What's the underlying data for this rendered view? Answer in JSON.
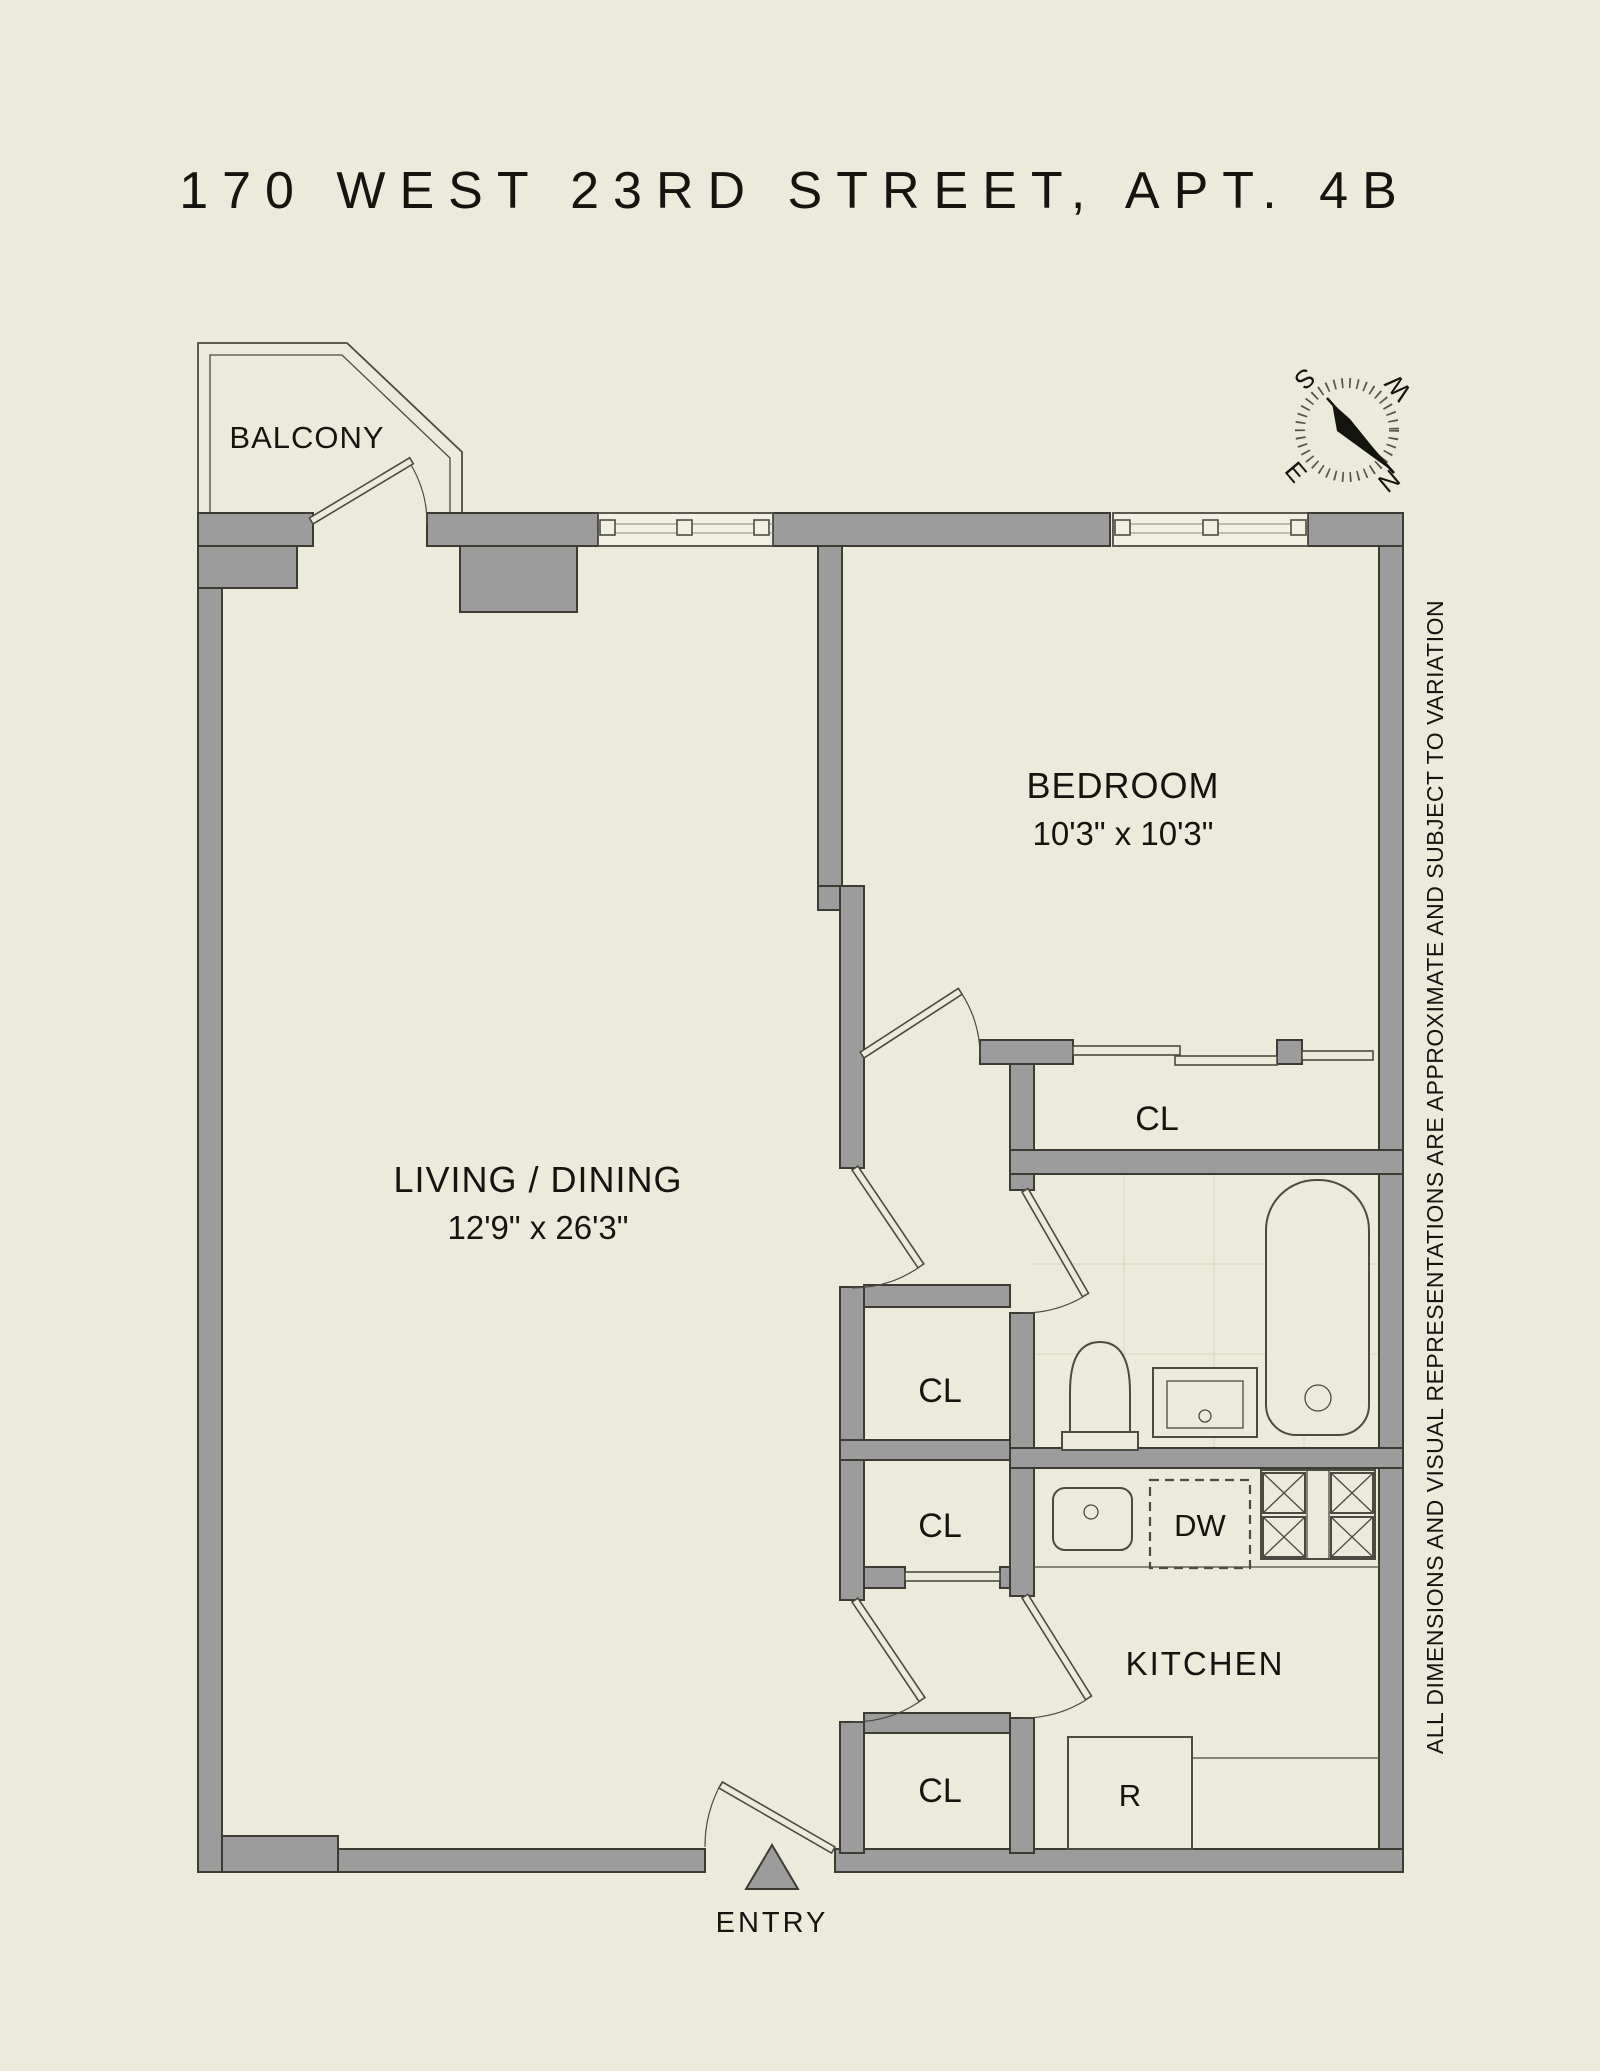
{
  "title": "170 WEST 23RD STREET, APT. 4B",
  "disclaimer": "ALL DIMENSIONS AND VISUAL REPRESENTATIONS ARE APPROXIMATE AND SUBJECT TO VARIATION",
  "rooms": {
    "balcony": {
      "label": "BALCONY"
    },
    "bedroom": {
      "label": "BEDROOM",
      "dims": "10'3\" x 10'3\""
    },
    "living": {
      "label": "LIVING / DINING",
      "dims": "12'9\" x 26'3\""
    },
    "kitchen": {
      "label": "KITCHEN"
    },
    "entry": {
      "label": "ENTRY"
    }
  },
  "closets": {
    "bedroom_closet": "CL",
    "hall_closet_upper": "CL",
    "hall_closet_lower": "CL",
    "entry_closet": "CL"
  },
  "appliances": {
    "dishwasher": "DW",
    "refrigerator": "R"
  },
  "compass": {
    "n": "N",
    "s": "S",
    "e": "E",
    "w": "W"
  },
  "colors": {
    "background": "#ECEADB",
    "wall_fill": "#9C9C9C",
    "wall_stroke": "#3C3C34",
    "line": "#4B4B41",
    "text": "#15150F",
    "window_fill": "#F1F0E2",
    "tile_line": "#DCD9C3"
  }
}
